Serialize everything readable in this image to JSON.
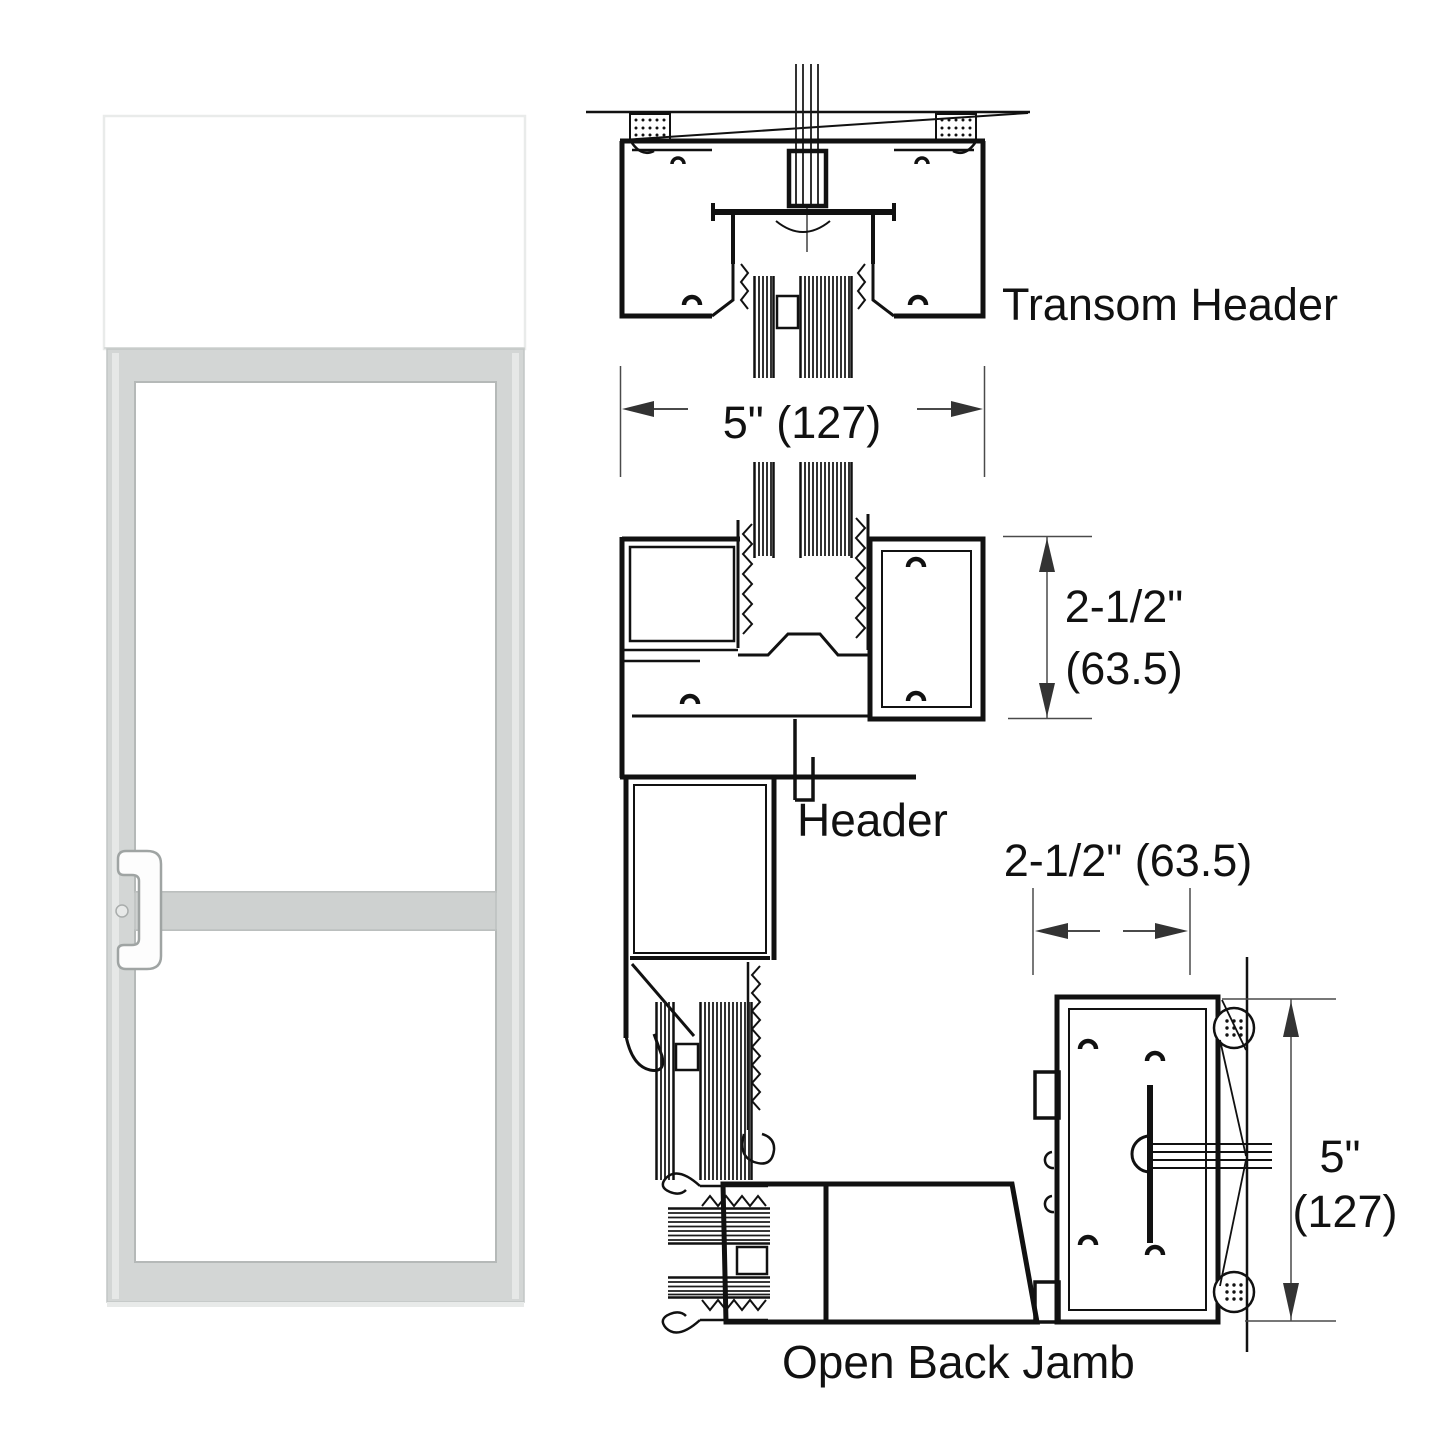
{
  "drawing": {
    "title_hint": "storefront door elevation with frame cross-sections",
    "line_color": "#111111",
    "dim_color": "#3c3c3c",
    "door_elevation": {
      "frame_color": "#d3d6d5",
      "rail_color": "#ced1d0",
      "edge_color": "#b5b9b8",
      "transom_border_color": "#e9ebea",
      "shadow_color": "#e8eae9"
    },
    "sections": {
      "transom_header": {
        "label": "Transom Header",
        "width_dim": "5\" (127)"
      },
      "header": {
        "label": "Header",
        "height_dim_in": "2-1/2\"",
        "height_dim_mm": "(63.5)"
      },
      "open_back_jamb": {
        "label": "Open Back Jamb",
        "width_dim": "2-1/2\" (63.5)",
        "height_dim_in": "5\"",
        "height_dim_mm": "(127)"
      }
    }
  }
}
